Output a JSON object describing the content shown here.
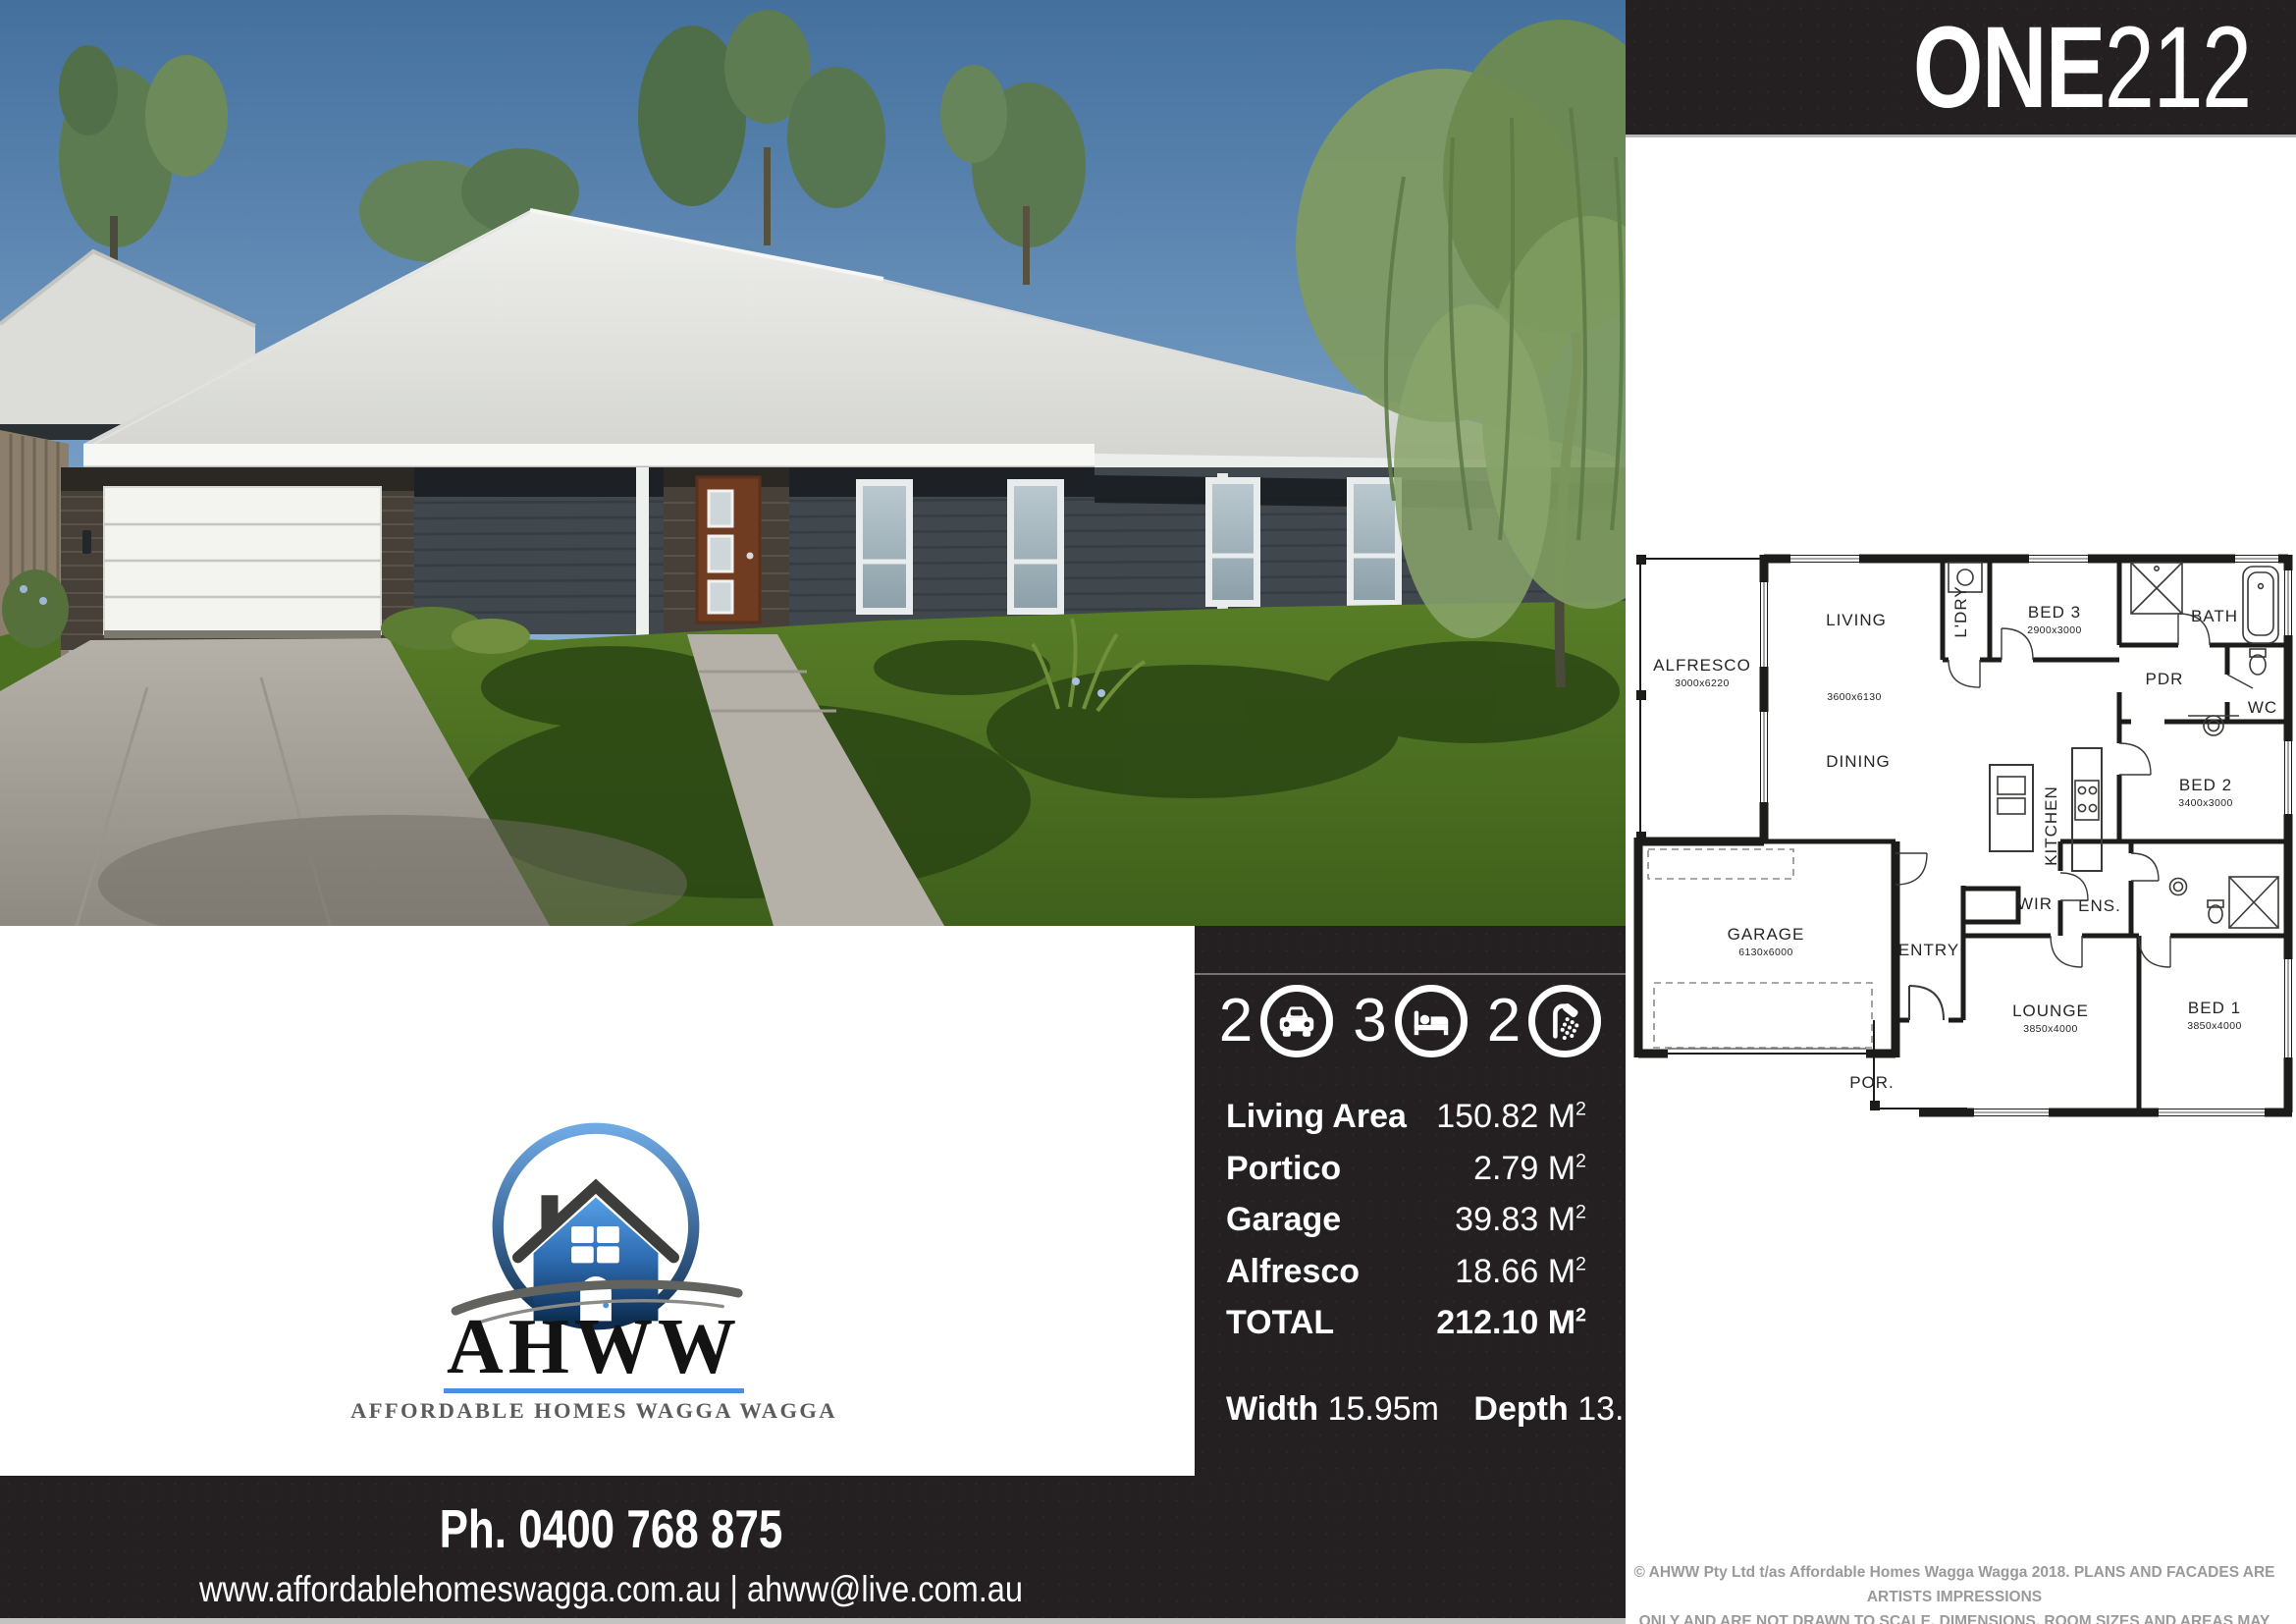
{
  "banner": {
    "title_bold": "ONE",
    "title_light": "212"
  },
  "stats": [
    {
      "icon": "car",
      "value": "2"
    },
    {
      "icon": "bed",
      "value": "3"
    },
    {
      "icon": "shower",
      "value": "2"
    }
  ],
  "specs": {
    "rows": [
      {
        "label": "Living Area",
        "value": "150.82"
      },
      {
        "label": "Portico",
        "value": "2.79"
      },
      {
        "label": "Garage",
        "value": "39.83"
      },
      {
        "label": "Alfresco",
        "value": "18.66"
      },
      {
        "label": "TOTAL",
        "value": "212.10"
      }
    ],
    "unit": "M",
    "unit_exp": "2",
    "width_label": "Width",
    "width_value": "15.95m",
    "depth_label": "Depth",
    "depth_value": "13.69m"
  },
  "floorplan": {
    "rooms": [
      {
        "label": "ALFRESCO",
        "dims": "3000x6220"
      },
      {
        "label": "LIVING",
        "dims": "3600x6130"
      },
      {
        "label": "DINING",
        "dims": ""
      },
      {
        "label": "L'DRY",
        "dims": ""
      },
      {
        "label": "BED 3",
        "dims": "2900x3000"
      },
      {
        "label": "BATH",
        "dims": ""
      },
      {
        "label": "PDR",
        "dims": ""
      },
      {
        "label": "WC",
        "dims": ""
      },
      {
        "label": "BED 2",
        "dims": "3400x3000"
      },
      {
        "label": "KITCHEN",
        "dims": ""
      },
      {
        "label": "GARAGE",
        "dims": "6130x6000"
      },
      {
        "label": "ENTRY",
        "dims": ""
      },
      {
        "label": "WIR",
        "dims": ""
      },
      {
        "label": "ENS.",
        "dims": ""
      },
      {
        "label": "LOUNGE",
        "dims": "3850x4000"
      },
      {
        "label": "BED 1",
        "dims": "3850x4000"
      },
      {
        "label": "POR.",
        "dims": ""
      }
    ]
  },
  "logo": {
    "brand": "AHWW",
    "tagline": "AFFORDABLE HOMES WAGGA WAGGA"
  },
  "footer": {
    "phone": "Ph. 0400 768 875",
    "web": "www.affordablehomeswagga.com.au | ahww@live.com.au"
  },
  "legal": {
    "line1": "© AHWW Pty Ltd t/as Affordable Homes Wagga Wagga  2018.  PLANS AND FACADES ARE ARTISTS IMPRESSIONS",
    "line2": "ONLY AND ARE NOT DRAWN TO SCALE.  DIMENSIONS, ROOM SIZES AND AREAS MAY VARY"
  },
  "colors": {
    "panel_black": "#242021",
    "brand_blue": "#4a90e2",
    "legal_gray": "#9a9a9a"
  }
}
